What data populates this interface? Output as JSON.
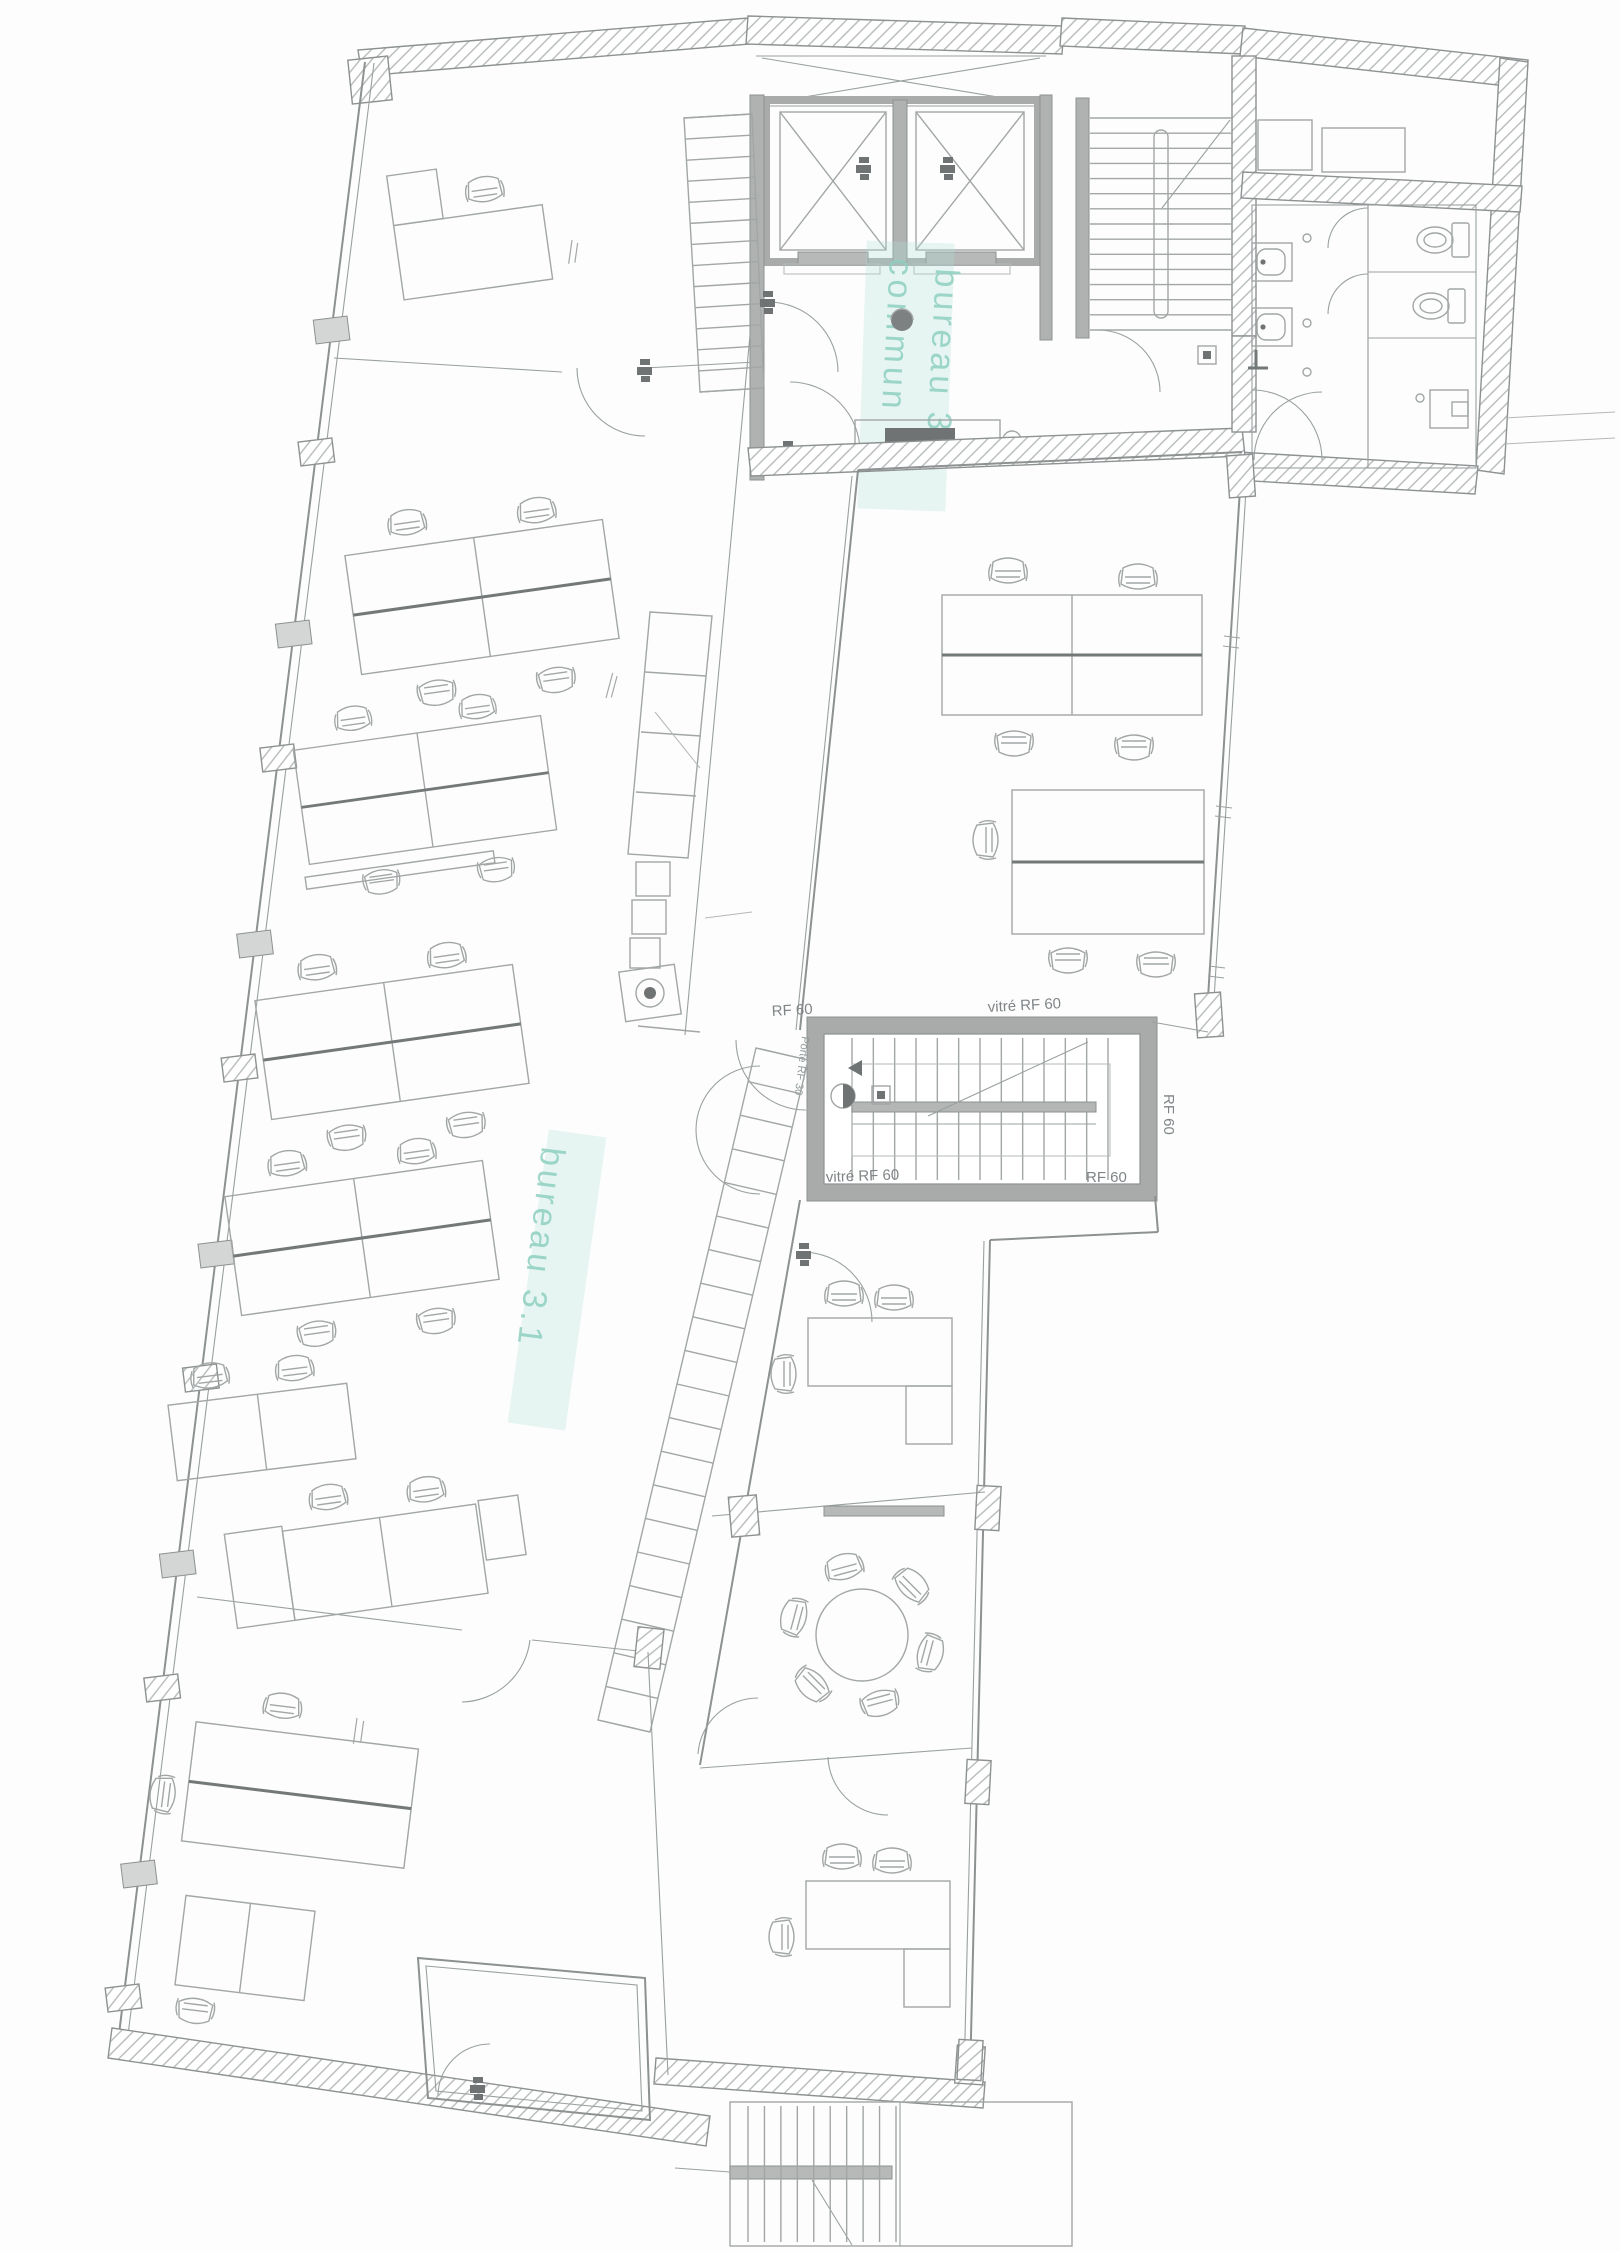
{
  "plan": {
    "type": "architectural floor plan",
    "highlight_labels": {
      "lobby_line1": "commun",
      "lobby_line2": "bureau 3",
      "open_office": "bureau 3.1"
    },
    "fire_rating_labels": {
      "rf60": "RF 60",
      "vitre_rf60": "vitré RF 60",
      "porte_rf30": "Porte RF 30"
    },
    "colors": {
      "label_teal": "#8fd0c0",
      "line_gray": "#8d9191",
      "wall_gray": "#b0b2b2",
      "hatch_gray": "#c2c2c2",
      "paper": "#fdfdfd"
    }
  }
}
